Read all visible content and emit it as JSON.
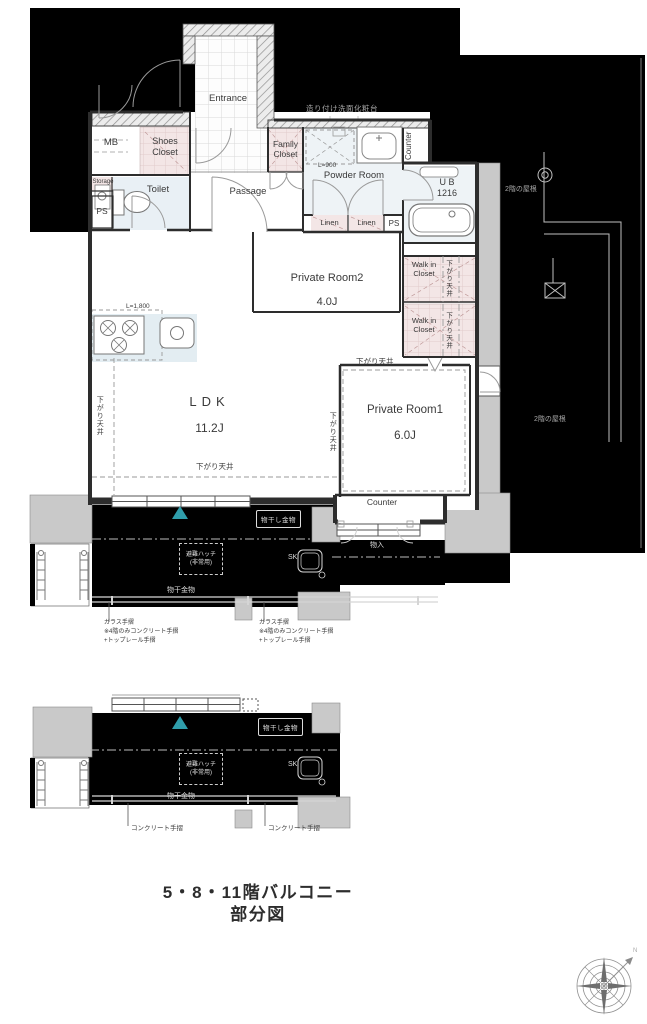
{
  "rooms": {
    "entrance": "Entrance",
    "mb": "MB",
    "shoes_closet": "Shoes\nCloset",
    "family_closet": "Family\nCloset",
    "storage": "Storage",
    "ps": "PS",
    "toilet": "Toilet",
    "passage": "Passage",
    "powder_room": "Powder Room",
    "counter": "Counter",
    "unit_bath": "U B\n1216",
    "linen": "Linen",
    "private_room2": "Private Room2",
    "private_room2_size": "4.0J",
    "walk_in_closet": "Walk in\nCloset",
    "ldk": "LDK",
    "ldk_size": "11.2J",
    "private_room1": "Private Room1",
    "private_room1_size": "6.0J",
    "storage_box": "物入"
  },
  "annotations": {
    "lowered_ceiling": "下がり天井",
    "kitchen_length": "L=1,800",
    "washer_length": "L=900",
    "builtin_vanity": "造り付け洗面化粧台",
    "lower_roof": "2階の屋根"
  },
  "balcony": {
    "evacuation_hatch": "避難ハッチ\n(非常用)",
    "slop_sink": "SK",
    "drying_fixture": "物干金物",
    "drying_fixture_boxed": "物干し金物",
    "glass_handrail_note": "ガラス手摺\n※4階のみコンクリート手摺\n+トップレール手摺",
    "concrete_handrail_note": "コンクリート手摺"
  },
  "caption": "5・8・11階バルコニー\n部分図",
  "compass": {
    "north": "N"
  },
  "colors": {
    "outside": "#000000",
    "closet_fill": "#f3e6e6",
    "wet_fill": "#e9f0f5",
    "kitchen_fill": "#e3edf2",
    "neighbor_fill": "#c9c9c9",
    "accent": "#2f9daa"
  }
}
